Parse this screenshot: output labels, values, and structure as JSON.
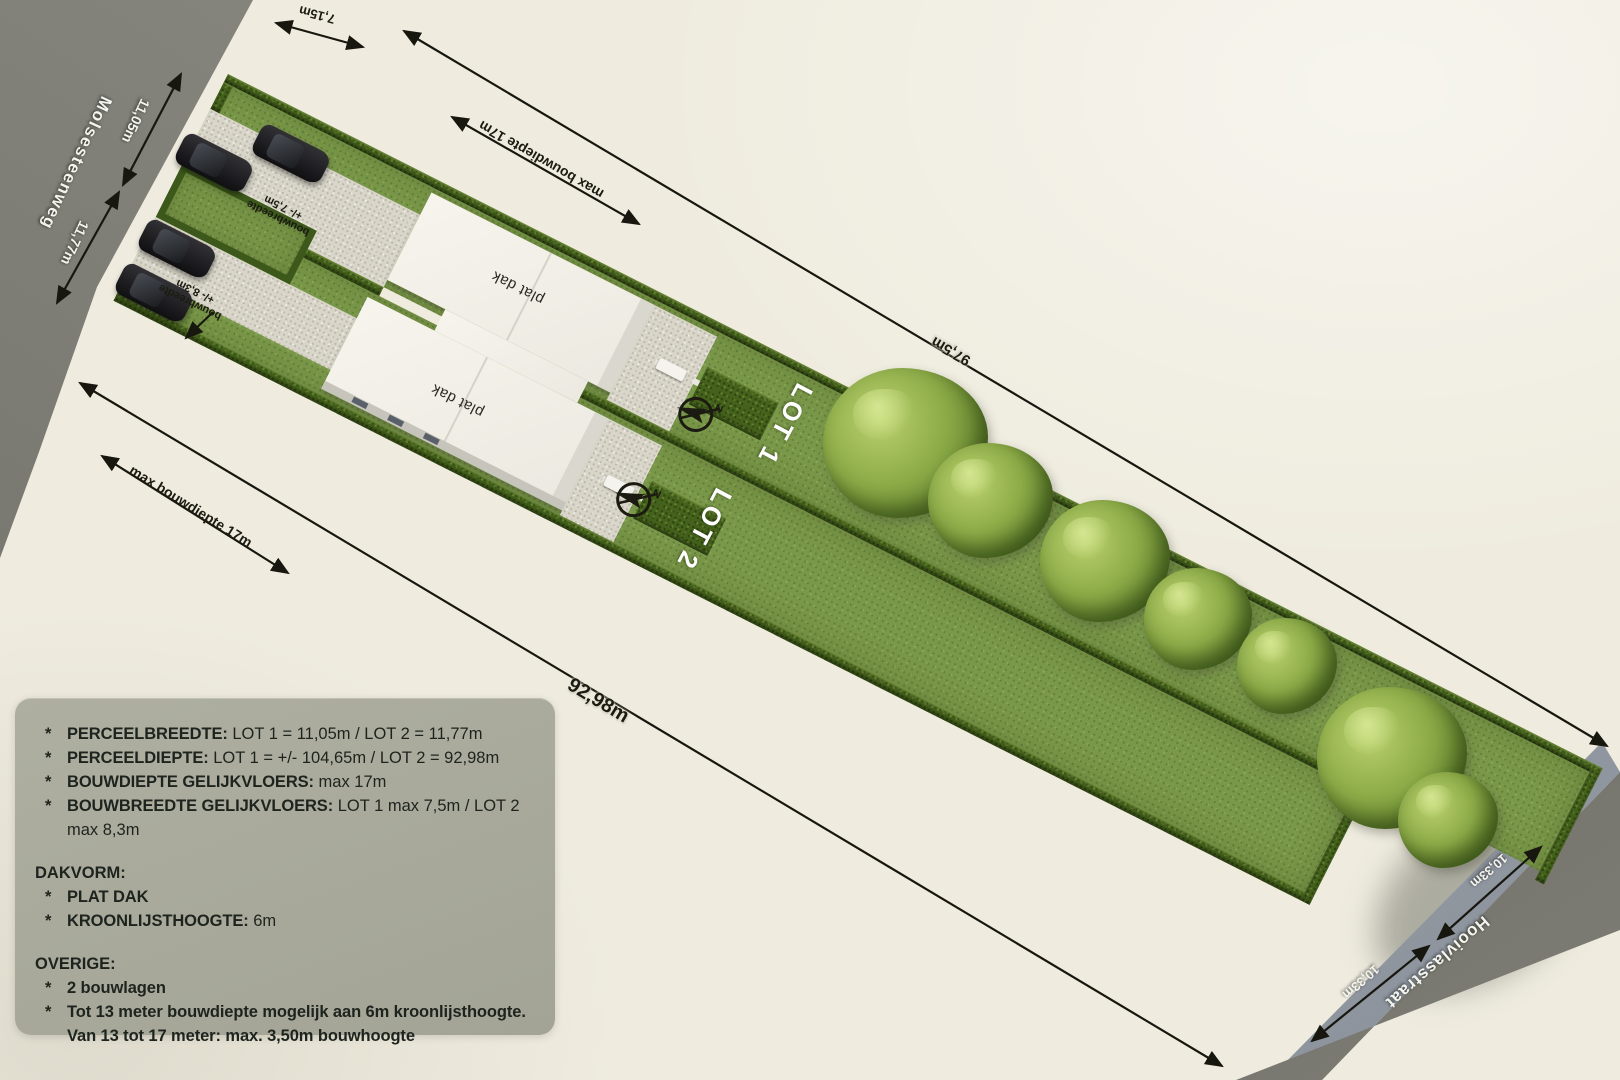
{
  "map": {
    "streets": {
      "molsesteenweg": "Molsesteenweg",
      "hooivlasstraat": "Hooivlasstraat"
    },
    "lots": {
      "lot1_label": "LOT 1",
      "lot2_label": "LOT 2"
    },
    "roofs": {
      "lot1": "plat dak",
      "lot2": "plat dak"
    },
    "dims": {
      "d715": "7,15m",
      "d1105": "11,05m",
      "d1177": "11,77m",
      "depth_top": "max bouwdiepte 17m",
      "depth_bottom": "max bouwdiepte 17m",
      "d975": "97,5m",
      "d9298": "92,98m",
      "d1033a": "10,33m",
      "d1033b": "10,33m",
      "bw75_line1": "bouwbreedte",
      "bw75_line2": "+/- 7,5m",
      "bw83_line1": "bouwbreedte",
      "bw83_line2": "+/- 8,3m"
    },
    "compass": {
      "n": "N"
    }
  },
  "info_box": {
    "bullet": "*",
    "items1": [
      {
        "label": "PERCEELBREEDTE:",
        "value": " LOT 1 = 11,05m / LOT 2 = 11,77m"
      },
      {
        "label": "PERCEELDIEPTE:",
        "value": " LOT 1 = +/- 104,65m / LOT 2 = 92,98m"
      },
      {
        "label": "BOUWDIEPTE GELIJKVLOERS:",
        "value": " max 17m"
      },
      {
        "label": "BOUWBREEDTE GELIJKVLOERS:",
        "value": " LOT 1 max 7,5m / LOT 2 max 8,3m"
      }
    ],
    "dakvorm_heading": "DAKVORM:",
    "dakvorm_items": [
      {
        "label": "PLAT DAK",
        "value": ""
      },
      {
        "label": "KROONLIJSTHOOGTE:",
        "value": " 6m"
      }
    ],
    "overige_heading": "OVERIGE:",
    "overige_items": [
      {
        "label": "2 bouwlagen",
        "value": ""
      },
      {
        "label": "Tot 13 meter bouwdiepte mogelijk aan 6m kroonlijsthoogte.",
        "value": ""
      }
    ],
    "overige_last_line2": "Van 13 tot 17 meter: max. 3,50m bouwhoogte"
  },
  "colors": {
    "background": "#efecdf",
    "road": "#85857d",
    "road_dark": "#6c6c64",
    "sidewalk": "#a3a9b4",
    "grass": "#7a9849",
    "hedge": "#44621b",
    "house": "#f1efe7",
    "gravel": "#d9d6c9",
    "infobox": "#a9aa9c",
    "dimension_line": "#17170f",
    "label_light": "#ffffff"
  }
}
